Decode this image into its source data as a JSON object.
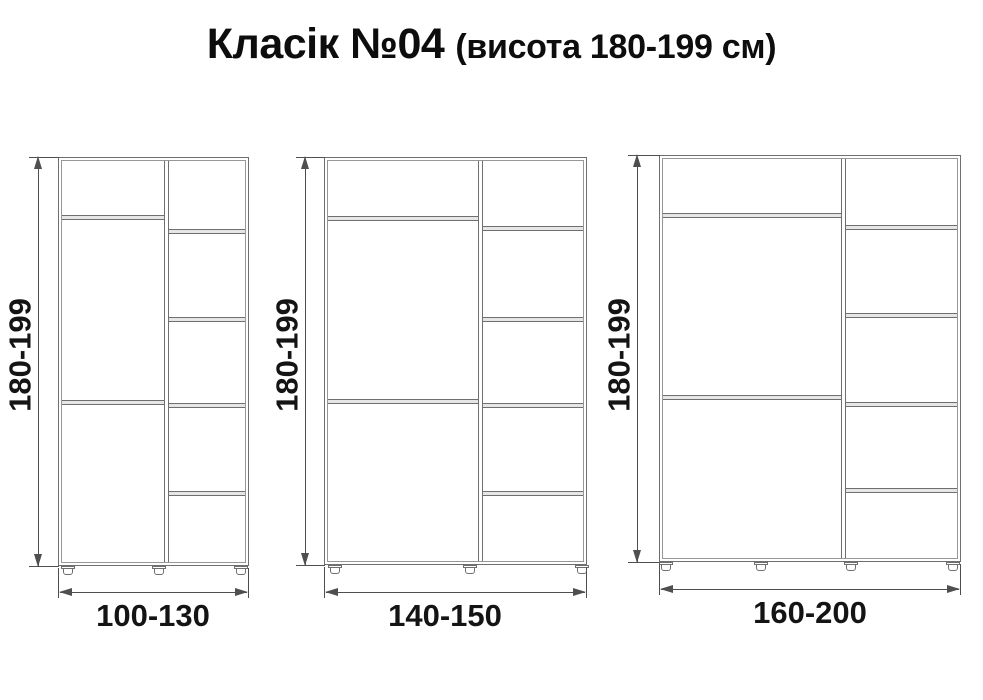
{
  "title": {
    "main": "Класік №04",
    "sub": "(висота 180-199 см)"
  },
  "colors": {
    "cabinet_line": "#6f6f6f",
    "cabinet_inner_line": "#989898",
    "shelf_fill": "#e6e6e6",
    "dimension_line": "#4f4f4f",
    "label_text": "#141414",
    "background": "#ffffff"
  },
  "wardrobes": [
    {
      "name": "wardrobe-100-130",
      "height_label": "180-199",
      "width_label": "100-130",
      "left_compartments": 3,
      "right_compartments": 5,
      "feet_count": 3
    },
    {
      "name": "wardrobe-140-150",
      "height_label": "180-199",
      "width_label": "140-150",
      "left_compartments": 3,
      "right_compartments": 5,
      "feet_count": 3
    },
    {
      "name": "wardrobe-160-200",
      "height_label": "180-199",
      "width_label": "160-200",
      "left_compartments": 3,
      "right_compartments": 5,
      "feet_count": 4
    }
  ]
}
